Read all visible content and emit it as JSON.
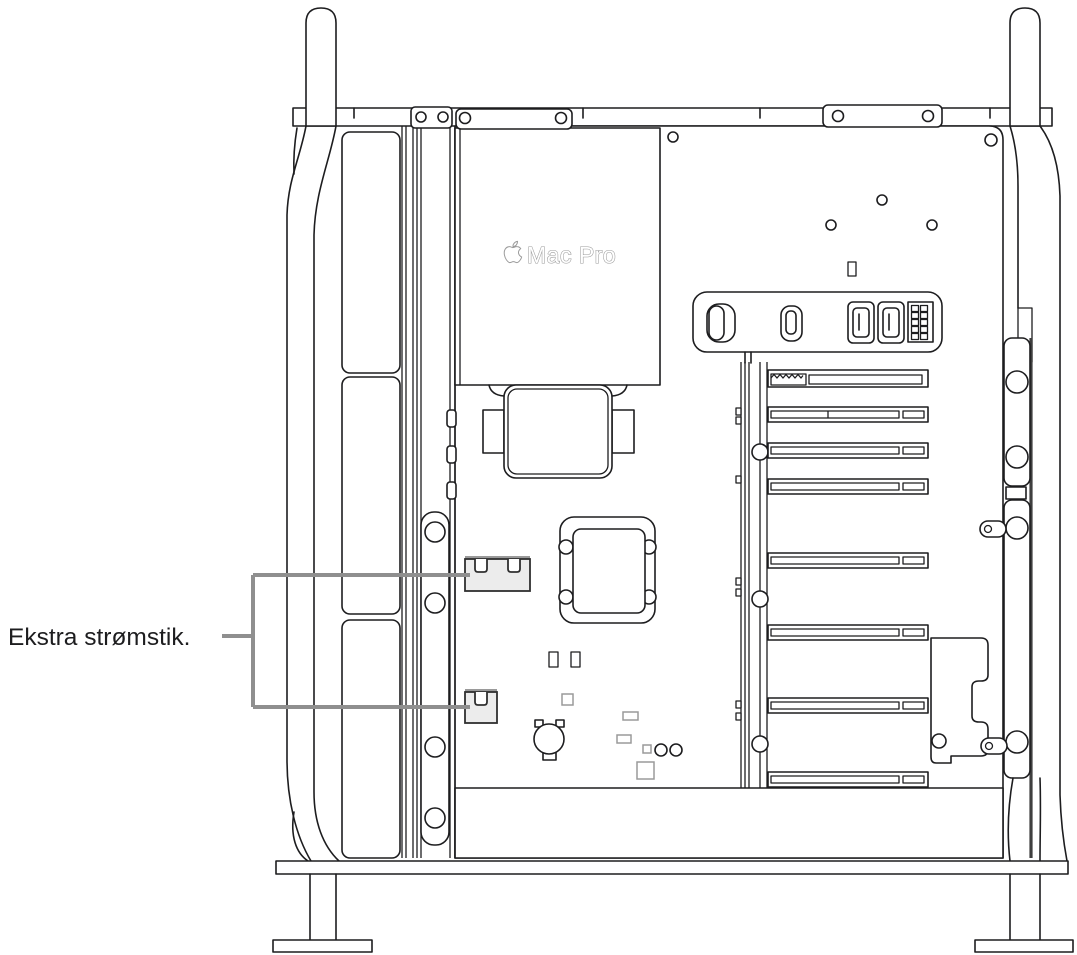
{
  "figure": {
    "description": "Line-art diagram of a Mac Pro tower lying open on its side, showing internal components",
    "callout": {
      "label": "Ekstra strømstik.",
      "points_to": [
        "auxiliary-power-connector-upper",
        "auxiliary-power-connector-lower"
      ]
    },
    "device": {
      "logo_icon": "apple-logo-icon",
      "logo_text": "Mac Pro"
    },
    "colors": {
      "background": "#ffffff",
      "line": "#1d1d1f",
      "callout_gray": "#8f8f8f",
      "logo_outline": "#9b9b9b",
      "connector_fill": "#ececec",
      "connector_stroke": "#303030",
      "component_gray": "#9a9a9a",
      "rail_dark": "#3f3f3f"
    }
  }
}
